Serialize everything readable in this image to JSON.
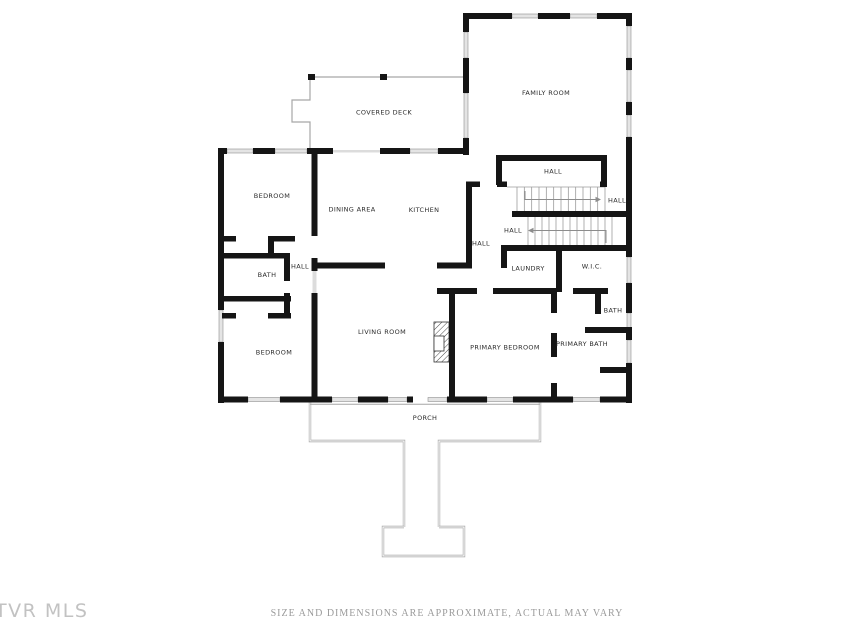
{
  "footer": {
    "disclaimer": "SIZE AND DIMENSIONS ARE APPROXIMATE, ACTUAL MAY VARY"
  },
  "watermark": {
    "text": "TVR MLS"
  },
  "floorplan": {
    "colors": {
      "wall": "#151515",
      "window_fill": "#e4e4e4",
      "window_stroke": "#8f8f8f",
      "opening": "#dcdcdc",
      "thin": "#a6a6a6",
      "tread": "#9c9c9c",
      "arrow": "#8c8c8c",
      "label": "#2b2b2b"
    },
    "rooms": [
      {
        "name": "family-room",
        "label": "FAMILY ROOM",
        "x": 546,
        "y": 93
      },
      {
        "name": "covered-deck",
        "label": "COVERED DECK",
        "x": 384,
        "y": 112.5
      },
      {
        "name": "bedroom-1",
        "label": "BEDROOM",
        "x": 272,
        "y": 196
      },
      {
        "name": "dining-area",
        "label": "DINING AREA",
        "x": 352,
        "y": 209.5
      },
      {
        "name": "kitchen",
        "label": "KITCHEN",
        "x": 424,
        "y": 210
      },
      {
        "name": "hall-upper",
        "label": "HALL",
        "x": 553,
        "y": 171.5
      },
      {
        "name": "hall-stairs-up",
        "label": "HALL",
        "x": 617,
        "y": 200.5
      },
      {
        "name": "hall-stairs-down",
        "label": "HALL",
        "x": 513,
        "y": 230.5
      },
      {
        "name": "hall-center",
        "label": "HALL",
        "x": 481,
        "y": 243.5
      },
      {
        "name": "hall-left",
        "label": "HALL",
        "x": 300,
        "y": 266.5
      },
      {
        "name": "bath-left",
        "label": "BATH",
        "x": 267,
        "y": 275
      },
      {
        "name": "laundry",
        "label": "LAUNDRY",
        "x": 528,
        "y": 268.5
      },
      {
        "name": "wic",
        "label": "W.I.C.",
        "x": 592,
        "y": 266.5
      },
      {
        "name": "bath-right",
        "label": "BATH",
        "x": 613,
        "y": 310.5
      },
      {
        "name": "living-room",
        "label": "LIVING ROOM",
        "x": 382,
        "y": 332
      },
      {
        "name": "bedroom-2",
        "label": "BEDROOM",
        "x": 274,
        "y": 352.5
      },
      {
        "name": "primary-bedroom",
        "label": "PRIMARY BEDROOM",
        "x": 505,
        "y": 347.5
      },
      {
        "name": "primary-bath",
        "label": "PRIMARY BATH",
        "x": 582,
        "y": 344
      },
      {
        "name": "porch",
        "label": "PORCH",
        "x": 425,
        "y": 418
      }
    ],
    "walls": [
      [
        218,
        148,
        6,
        162
      ],
      [
        218,
        342,
        6,
        61
      ],
      [
        218,
        148,
        9,
        6
      ],
      [
        253,
        148,
        22,
        6
      ],
      [
        307,
        148,
        26,
        6
      ],
      [
        380,
        148,
        30,
        6
      ],
      [
        438,
        148,
        30,
        6
      ],
      [
        218,
        396.5,
        30,
        6
      ],
      [
        280,
        396.5,
        52,
        6
      ],
      [
        358,
        396.5,
        30,
        6
      ],
      [
        407,
        396.5,
        6,
        6
      ],
      [
        447,
        396.5,
        40,
        6
      ],
      [
        513,
        396.5,
        60,
        6
      ],
      [
        600,
        396.5,
        32,
        6
      ],
      [
        626,
        13,
        6,
        13
      ],
      [
        626,
        58,
        6,
        12
      ],
      [
        626,
        102,
        6,
        13
      ],
      [
        626,
        137,
        6,
        120
      ],
      [
        626,
        283,
        6,
        30
      ],
      [
        626,
        330,
        6,
        10
      ],
      [
        626,
        363,
        6,
        40
      ],
      [
        463,
        13,
        49,
        6
      ],
      [
        538,
        13,
        32,
        6
      ],
      [
        597,
        13,
        35,
        6
      ],
      [
        463,
        13,
        6,
        19
      ],
      [
        463,
        58,
        6,
        35
      ],
      [
        463,
        138,
        6,
        17
      ],
      [
        311.5,
        154,
        6,
        82
      ],
      [
        311.5,
        258,
        6,
        13
      ],
      [
        311.5,
        293,
        6,
        103.5
      ],
      [
        313,
        262.5,
        72,
        6
      ],
      [
        437,
        262.5,
        35,
        6
      ],
      [
        466,
        185,
        6,
        77.5
      ],
      [
        466,
        181.5,
        14,
        5.5
      ],
      [
        497,
        181.5,
        10,
        5.5
      ],
      [
        600,
        181.5,
        7,
        5.5
      ],
      [
        496,
        155,
        111,
        6
      ],
      [
        496,
        161,
        6,
        24
      ],
      [
        601,
        161,
        6,
        24
      ],
      [
        512,
        211,
        120,
        6
      ],
      [
        501,
        245,
        131,
        6
      ],
      [
        501,
        251,
        6,
        17
      ],
      [
        556,
        251,
        6,
        41
      ],
      [
        437,
        288,
        40,
        6
      ],
      [
        493,
        288,
        64,
        6
      ],
      [
        573,
        288,
        35,
        6
      ],
      [
        595,
        294,
        6,
        20
      ],
      [
        585,
        327,
        47,
        6
      ],
      [
        551,
        294,
        6,
        19
      ],
      [
        551,
        333,
        6,
        24
      ],
      [
        551,
        383,
        6,
        13.5
      ],
      [
        449,
        294,
        6,
        102.5
      ],
      [
        600,
        367,
        32,
        6
      ],
      [
        224,
        236,
        12,
        5.5
      ],
      [
        268,
        236,
        27,
        5.5
      ],
      [
        268,
        236,
        6,
        22
      ],
      [
        224,
        253,
        66,
        5.5
      ],
      [
        284,
        253,
        6,
        28
      ],
      [
        284,
        293,
        6,
        25
      ],
      [
        222,
        296,
        69,
        5.5
      ],
      [
        222,
        313,
        14,
        5.5
      ],
      [
        268,
        313,
        23,
        5.5
      ]
    ],
    "windows": [
      [
        227,
        149,
        26,
        4
      ],
      [
        275,
        149,
        32,
        4
      ],
      [
        410,
        149,
        28,
        4
      ],
      [
        248,
        397.5,
        32,
        4
      ],
      [
        332,
        397.5,
        26,
        4
      ],
      [
        388,
        397.5,
        19,
        4
      ],
      [
        428,
        397.5,
        19,
        4
      ],
      [
        487,
        397.5,
        26,
        4
      ],
      [
        573,
        397.5,
        27,
        4
      ],
      [
        627,
        26,
        4,
        32
      ],
      [
        627,
        70,
        4,
        32
      ],
      [
        627,
        115,
        4,
        22
      ],
      [
        627,
        257,
        4,
        26
      ],
      [
        627,
        313,
        4,
        17
      ],
      [
        627,
        340,
        4,
        23
      ],
      [
        512,
        14,
        26,
        4
      ],
      [
        570,
        14,
        27,
        4
      ],
      [
        464,
        32,
        4,
        26
      ],
      [
        464,
        93,
        4,
        45
      ],
      [
        219,
        310,
        4,
        32
      ]
    ],
    "openings": [
      [
        333,
        150,
        47,
        2.5
      ],
      [
        312.5,
        271,
        4,
        22
      ]
    ],
    "deck": {
      "path": "M310,148 L310,122 L292,122 L292,100 L310,100 L310,77 L463,77"
    },
    "posts": [
      [
        308,
        74,
        7,
        6
      ],
      [
        380,
        74,
        7,
        6
      ]
    ],
    "porch": {
      "double_paths": [
        "M310,402.5 L310,441 L404,441 L404,527",
        "M540,402.5 L540,441 L439,441 L439,527",
        "M404,527 L383,527 L383,556 L464,556 L464,527 L439,527"
      ],
      "single_lines": [
        "M310,404.2 L540,404.2"
      ]
    },
    "stairs": [
      {
        "x1": 517,
        "x2": 605,
        "y1": 187,
        "y2": 211,
        "n": 13,
        "edge": [
          507,
          187,
          605,
          187
        ]
      },
      {
        "x1": 528,
        "x2": 612,
        "y1": 217,
        "y2": 245,
        "n": 13,
        "edge": null
      }
    ],
    "arrows": [
      {
        "line": "525,191 525,199.5 597,199.5",
        "head": "601,199.5 595.5,196.8 595.5,202.2"
      },
      {
        "line": "531,230.5 606,230.5 606,243",
        "head": "528,230.5 533.5,227.8 533.5,233.2"
      }
    ],
    "fireplace": {
      "outer": [
        434,
        322,
        15,
        40
      ],
      "inner": [
        434,
        336,
        10,
        15
      ]
    }
  }
}
